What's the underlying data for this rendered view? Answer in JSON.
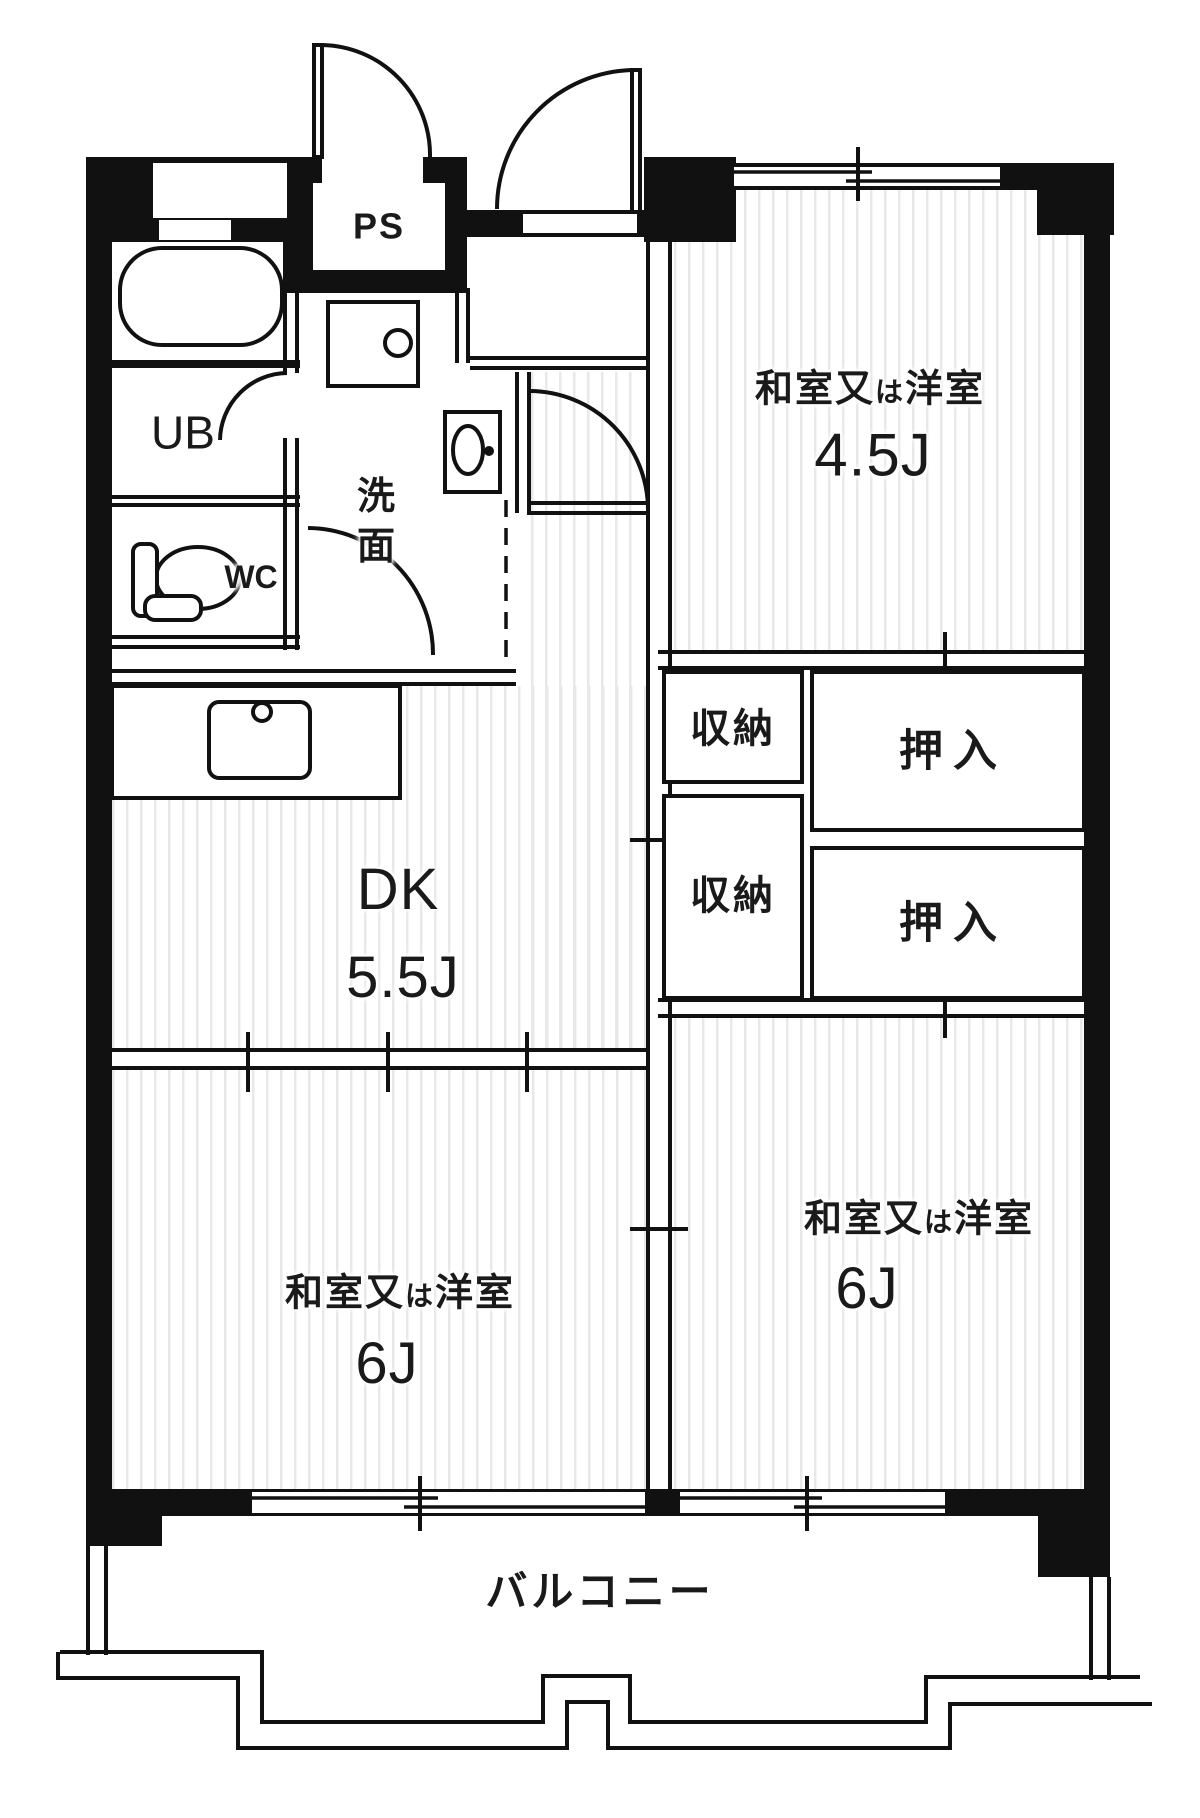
{
  "colors": {
    "wall": "#111111",
    "stripe": "#e8e8e8",
    "floor": "#ffffff"
  },
  "labels": {
    "ps": "PS",
    "ub": "UB",
    "wc": "WC",
    "washroom": "洗\n面",
    "balcony": "バルコニー"
  },
  "rooms": {
    "dk": {
      "name": "DK",
      "size": "5.5J"
    },
    "northeast": {
      "label_main_1": "和室又",
      "label_small": "は",
      "label_main_2": "洋室",
      "size": "4.5J"
    },
    "southwest": {
      "label_main_1": "和室又",
      "label_small": "は",
      "label_main_2": "洋室",
      "size": "6J"
    },
    "southeast": {
      "label_main_1": "和室又",
      "label_small": "は",
      "label_main_2": "洋室",
      "size": "6J"
    }
  },
  "storage": {
    "closet_upper": "収納",
    "closet_lower": "収納",
    "oshiire_upper": "押入",
    "oshiire_lower": "押入"
  }
}
